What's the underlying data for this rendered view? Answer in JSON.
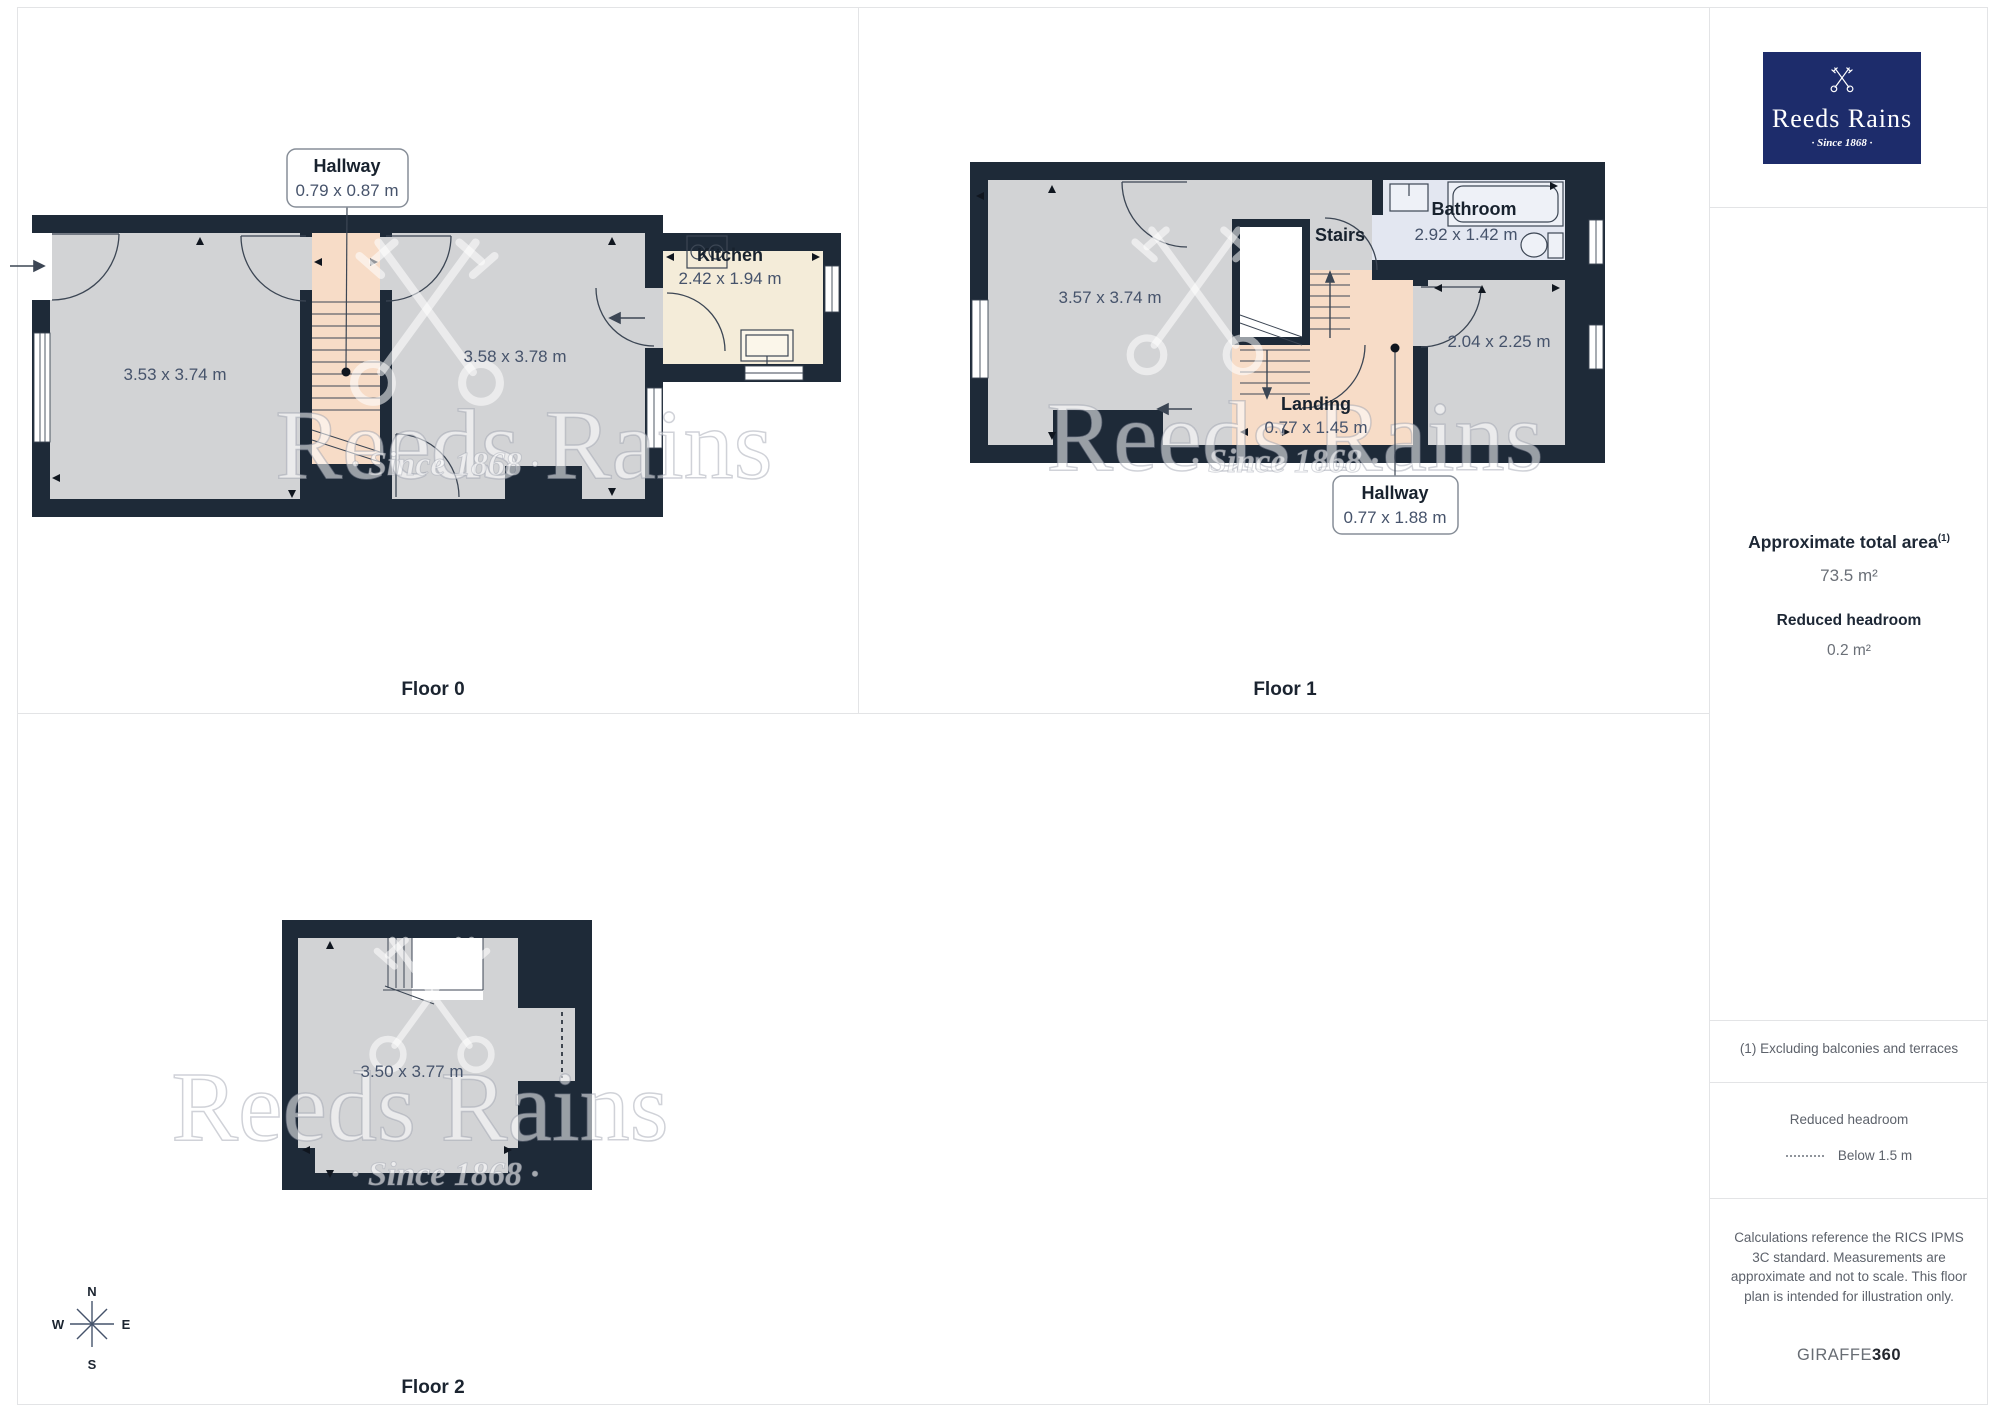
{
  "floors": {
    "floor0": {
      "label": "Floor 0",
      "callout": {
        "title": "Hallway",
        "dims": "0.79 x 0.87 m"
      },
      "rooms": {
        "left": "3.53 x 3.74 m",
        "middle": "3.58 x 3.78 m",
        "kitchen_name": "Kitchen",
        "kitchen_dims": "2.42 x 1.94 m"
      }
    },
    "floor1": {
      "label": "Floor 1",
      "callout": {
        "title": "Hallway",
        "dims": "0.77 x 1.88 m"
      },
      "rooms": {
        "left": "3.57 x 3.74 m",
        "stairs": "Stairs",
        "bathroom_name": "Bathroom",
        "bathroom_dims": "2.92 x 1.42 m",
        "right": "2.04 x 2.25 m",
        "landing_name": "Landing",
        "landing_dims": "0.77 x 1.45 m"
      }
    },
    "floor2": {
      "label": "Floor 2",
      "rooms": {
        "main": "3.50 x 3.77 m"
      }
    }
  },
  "compass": {
    "north": "N",
    "east": "E",
    "south": "S",
    "west": "W"
  },
  "watermark": {
    "brand": "Reeds Rains",
    "since": "· Since 1868 ·"
  },
  "sidebar": {
    "logo": {
      "brand": "Reeds Rains",
      "since": "· Since 1868 ·"
    },
    "area": {
      "title": "Approximate total area",
      "superscript": "(1)",
      "value": "73.5 m²",
      "headroom_title": "Reduced headroom",
      "headroom_value": "0.2 m²"
    },
    "footnote": "(1) Excluding balconies and terraces",
    "legend": {
      "title": "Reduced headroom",
      "item": "Below 1.5 m"
    },
    "disclaimer": "Calculations reference the RICS IPMS 3C standard. Measurements are approximate and not to scale. This floor plan is intended for illustration only.",
    "brand": {
      "giraffe": "GIRAFFE",
      "three_sixty": "360"
    }
  },
  "colors": {
    "wall": "#1e2a38",
    "floor_gray": "#d2d3d5",
    "stairs_peach": "#f7dcc7",
    "kitchen_cream": "#f4ecd9",
    "bathroom_blue": "#e3e7f1",
    "logo_navy": "#1d2c6b"
  }
}
